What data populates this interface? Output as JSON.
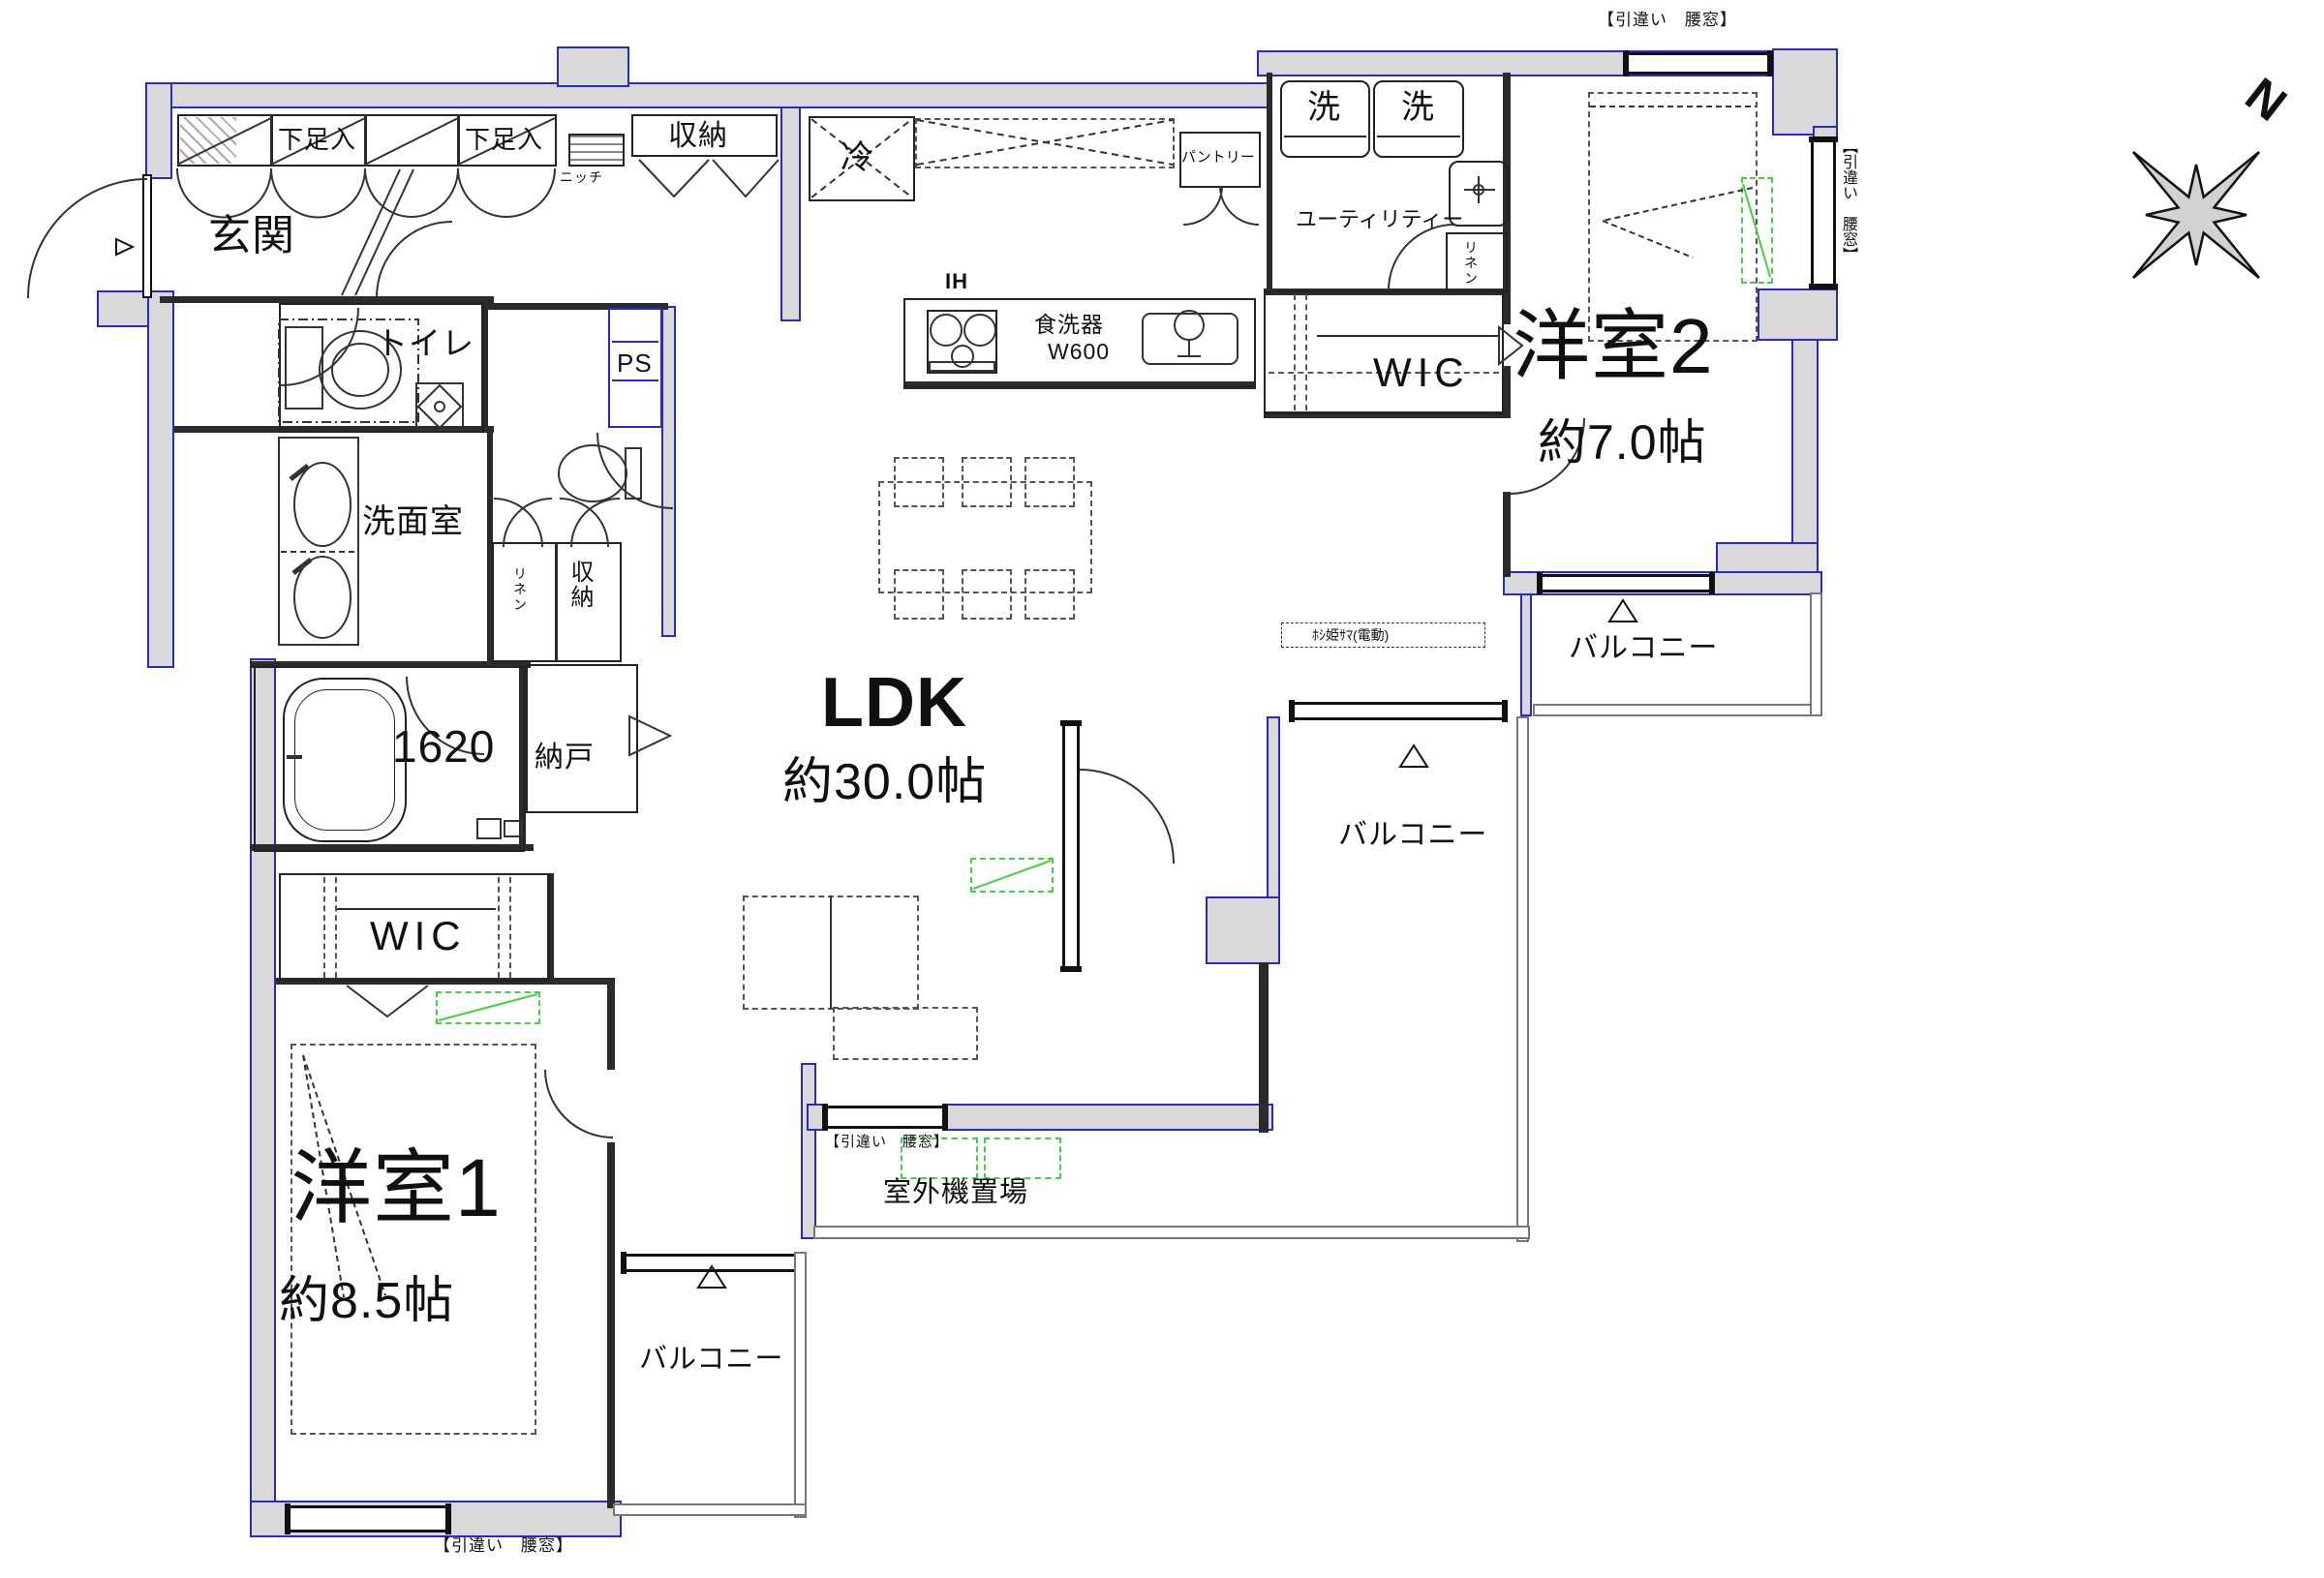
{
  "labels": {
    "genkan": "玄関",
    "shoe1": "下足入",
    "shoe2": "下足入",
    "niche": "ニッチ",
    "hall_closet": "収納",
    "fridge": "冷",
    "pantry": "パントリー",
    "wash1": "洗",
    "wash2": "洗",
    "utility": "ユーティリティー",
    "linen_utility": "リネン",
    "ih": "IH",
    "dishwasher": "食洗器",
    "dishwasher_width": "W600",
    "wic2": "WIC",
    "bedroom2": "洋室2",
    "bedroom2_size": "約7.0帖",
    "toilet": "トイレ",
    "ps": "PS",
    "washroom": "洗面室",
    "linen_wash": "リネン",
    "closet_wash": "収納",
    "bath_size": "1620",
    "storeroom": "納戸",
    "wic1": "WIC",
    "bedroom1": "洋室1",
    "bedroom1_size": "約8.5帖",
    "ldk": "LDK",
    "ldk_size": "約30.0帖",
    "hoshihime": "ﾎｼ姫ｻﾏ(電動)",
    "balcony_tr": "バルコニー",
    "balcony_mid": "バルコニー",
    "balcony_bl": "バルコニー",
    "outdoor_unit": "室外機置場",
    "win_top": "【引違い　腰窓】",
    "win_right": "【引違い　腰窓】",
    "win_ldk": "【引違い　腰窓】",
    "win_bottom": "【引違い　腰窓】",
    "north": "N"
  },
  "colors": {
    "wall_fill": "#d9d9d9",
    "wall_line": "#2a2ac8",
    "accent_green": "#3fd43f",
    "line": "#333333"
  }
}
